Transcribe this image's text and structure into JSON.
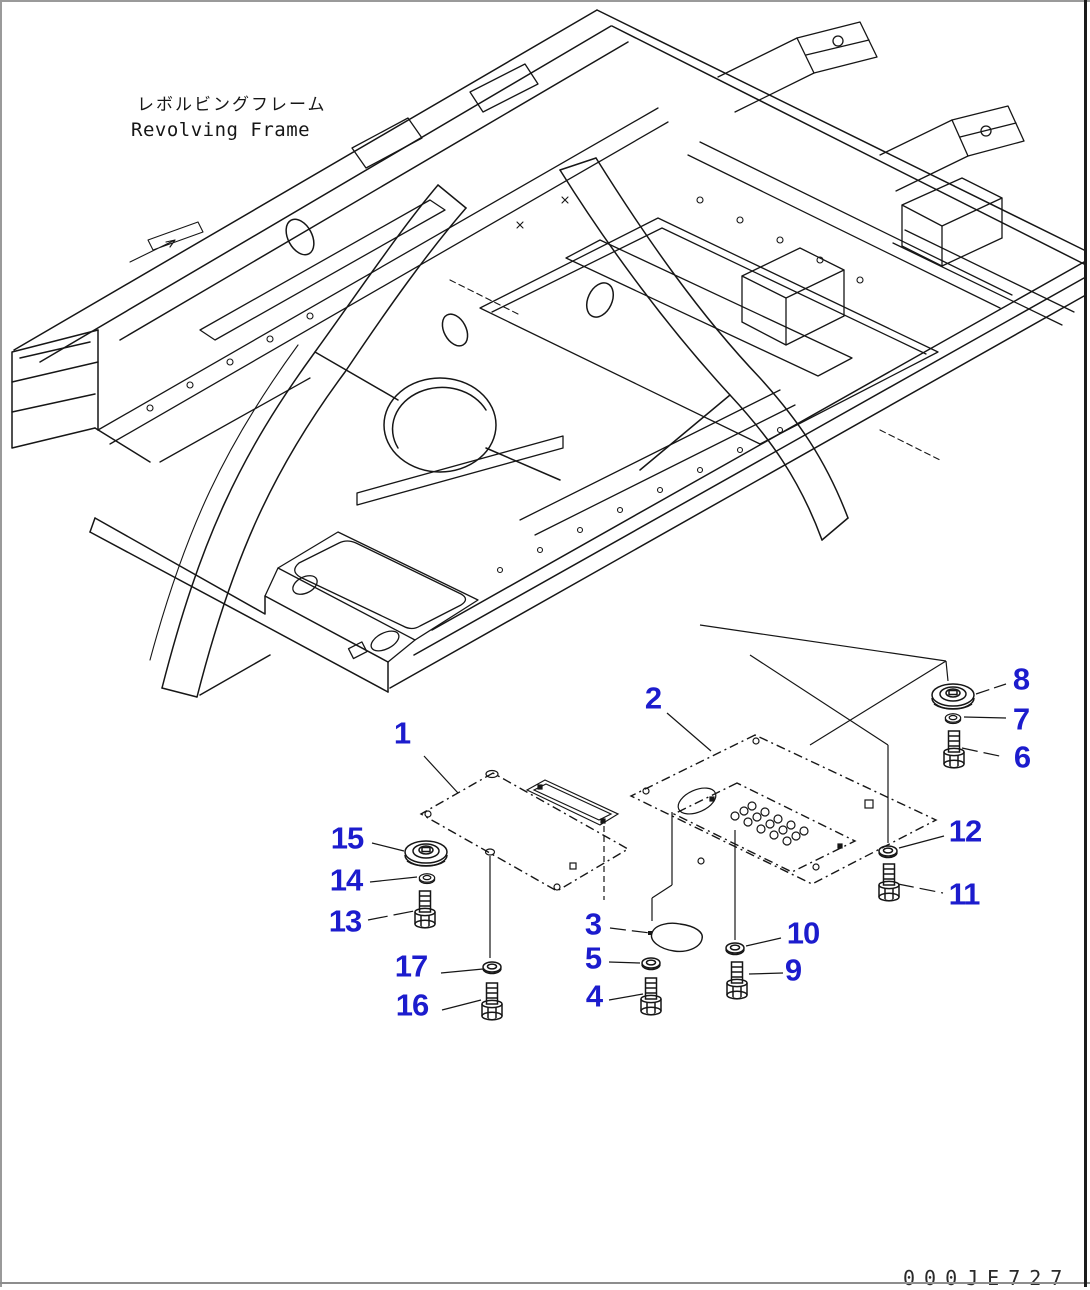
{
  "title": {
    "jp": "レボルビングフレーム",
    "en": "Revolving Frame"
  },
  "drawing_number": "000JE727",
  "colors": {
    "line": "#161616",
    "callout_blue": "#1c1ccd",
    "sheet_border": "#8d8d8d"
  },
  "callouts": [
    {
      "label": "1",
      "x": 402,
      "y": 733
    },
    {
      "label": "2",
      "x": 653,
      "y": 698
    },
    {
      "label": "3",
      "x": 593,
      "y": 924
    },
    {
      "label": "4",
      "x": 594,
      "y": 996
    },
    {
      "label": "5",
      "x": 593,
      "y": 958
    },
    {
      "label": "6",
      "x": 1022,
      "y": 757
    },
    {
      "label": "7",
      "x": 1021,
      "y": 719
    },
    {
      "label": "8",
      "x": 1021,
      "y": 679
    },
    {
      "label": "9",
      "x": 793,
      "y": 970
    },
    {
      "label": "10",
      "x": 803,
      "y": 933
    },
    {
      "label": "11",
      "x": 964,
      "y": 894
    },
    {
      "label": "12",
      "x": 965,
      "y": 831
    },
    {
      "label": "13",
      "x": 345,
      "y": 921
    },
    {
      "label": "14",
      "x": 346,
      "y": 880
    },
    {
      "label": "15",
      "x": 347,
      "y": 838
    },
    {
      "label": "16",
      "x": 412,
      "y": 1005
    },
    {
      "label": "17",
      "x": 411,
      "y": 966
    }
  ]
}
